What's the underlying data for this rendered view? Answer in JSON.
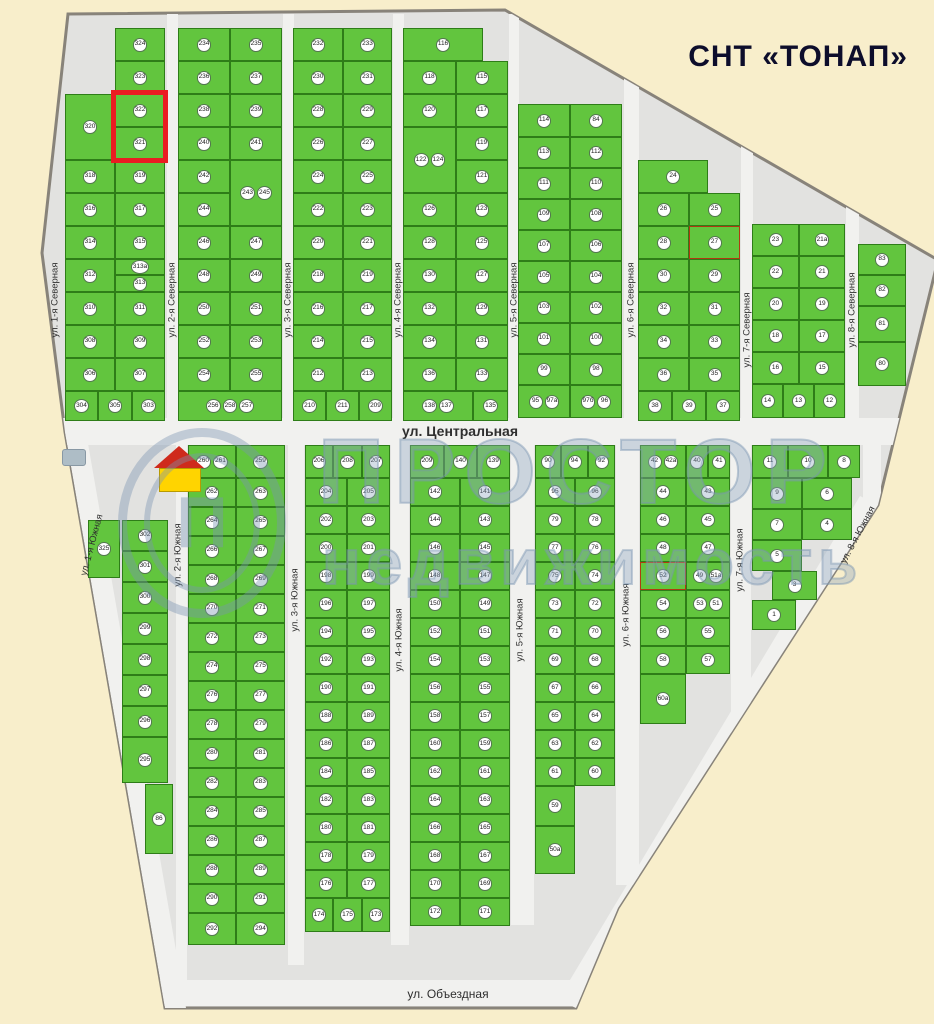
{
  "title": "СНТ «ТОНАП»",
  "watermark": {
    "line1": "ПРОСТОР",
    "line2": "недвижимость",
    "logo_letter": "П"
  },
  "colors": {
    "page": "#f8eecb",
    "map": "#e2e2e0",
    "street": "#f1f1ef",
    "plot": "#62c53e",
    "plot-border": "#2e7d18",
    "badge-bg": "#ffffff",
    "badge-border": "#53774f",
    "label": "#222222",
    "highlight": "#ea1c22",
    "title": "#0d0d2b",
    "street-text": "#2f2f2f",
    "accent": "#b03a10",
    "watermark": "#8fa6bf"
  },
  "highlight_plots": [
    "322",
    "321"
  ],
  "streets": [
    {
      "n": "ул. 1-я Северная",
      "x": 55,
      "y": 300,
      "a": -90
    },
    {
      "n": "ул. 2-я Северная",
      "x": 172,
      "y": 300,
      "a": -90
    },
    {
      "n": "ул. 3-я Северная",
      "x": 288,
      "y": 300,
      "a": -90
    },
    {
      "n": "ул. 4-я Северная",
      "x": 398,
      "y": 300,
      "a": -90
    },
    {
      "n": "ул. 5-я Северная",
      "x": 514,
      "y": 300,
      "a": -90
    },
    {
      "n": "ул. 6-я Северная",
      "x": 631,
      "y": 300,
      "a": -90
    },
    {
      "n": "ул. 7-я Северная",
      "x": 747,
      "y": 330,
      "a": -90
    },
    {
      "n": "ул. 8-я Северная",
      "x": 852,
      "y": 310,
      "a": -90
    },
    {
      "n": "ул. Центральная",
      "x": 460,
      "y": 431,
      "a": 0,
      "fs": 14,
      "b": 1
    },
    {
      "n": "ул. 1-я Южная",
      "x": 92,
      "y": 545,
      "a": -75
    },
    {
      "n": "ул. 2-я Южная",
      "x": 178,
      "y": 555,
      "a": -90
    },
    {
      "n": "ул. 3-я Южная",
      "x": 295,
      "y": 600,
      "a": -90
    },
    {
      "n": "ул. 4-я Южная",
      "x": 399,
      "y": 640,
      "a": -90
    },
    {
      "n": "ул. 5-я Южная",
      "x": 520,
      "y": 630,
      "a": -90
    },
    {
      "n": "ул. 6-я Южная",
      "x": 626,
      "y": 615,
      "a": -90
    },
    {
      "n": "ул. 7-я Южная",
      "x": 740,
      "y": 560,
      "a": -90
    },
    {
      "n": "ул. 8-я Южная",
      "x": 858,
      "y": 535,
      "a": -62
    },
    {
      "n": "ул. Объездная",
      "x": 448,
      "y": 994,
      "a": 0,
      "fs": 12
    }
  ],
  "blocks": [
    {
      "name": "north-1",
      "strips": [
        {
          "x": 65,
          "y": 94,
          "w": 50,
          "dir": "v",
          "cs": 33,
          "cells": [
            {
              "n": "320",
              "s": 66
            },
            "318",
            "316",
            "314",
            "312",
            "310",
            "308",
            "306"
          ]
        },
        {
          "x": 115,
          "y": 28,
          "w": 50,
          "dir": "v",
          "cs": 33,
          "cells": [
            "324",
            "323",
            "322",
            "321",
            "319",
            "317",
            "315",
            {
              "n": "313а",
              "s": 16
            },
            {
              "n": "313",
              "s": 17
            },
            "311",
            "309",
            "307"
          ]
        },
        {
          "x": 65,
          "y": 391,
          "h": 30,
          "dir": "h",
          "cs": 33,
          "cells": [
            "304",
            {
              "n": "305",
              "s": 34
            },
            "303"
          ]
        }
      ]
    },
    {
      "name": "north-2",
      "strips": [
        {
          "x": 178,
          "y": 28,
          "w": 52,
          "dir": "v",
          "cs": 33,
          "cells": [
            "234",
            "236",
            "238",
            "240",
            "242",
            "244",
            "246",
            "248",
            "250",
            "252",
            "254"
          ]
        },
        {
          "x": 230,
          "y": 28,
          "w": 52,
          "dir": "v",
          "cs": 33,
          "cells": [
            "235",
            "237",
            "239",
            "241",
            {
              "ns": [
                "243",
                "245"
              ],
              "s": 66
            },
            "247",
            "249",
            "251",
            "253",
            "255"
          ]
        },
        {
          "x": 178,
          "y": 391,
          "h": 30,
          "dir": "h",
          "cs": 104,
          "cells": [
            {
              "ns": [
                "256",
                "258",
                "257"
              ]
            }
          ]
        }
      ]
    },
    {
      "name": "north-3",
      "strips": [
        {
          "x": 293,
          "y": 28,
          "w": 50,
          "dir": "v",
          "cs": 33,
          "cells": [
            "232",
            "230",
            "228",
            "226",
            "224",
            "222",
            "220",
            "218",
            "216",
            "214",
            "212"
          ]
        },
        {
          "x": 343,
          "y": 28,
          "w": 49,
          "dir": "v",
          "cs": 33,
          "cells": [
            "233",
            "231",
            "229",
            "227",
            "225",
            "223",
            "221",
            "219",
            "217",
            "215",
            "213"
          ]
        },
        {
          "x": 293,
          "y": 391,
          "h": 30,
          "dir": "h",
          "cs": 33,
          "cells": [
            "210",
            "211",
            "209"
          ]
        }
      ]
    },
    {
      "name": "north-4",
      "strips": [
        {
          "x": 403,
          "y": 28,
          "h": 33,
          "dir": "h",
          "cs": 80,
          "cells": [
            {
              "n": "116"
            }
          ]
        },
        {
          "x": 403,
          "y": 61,
          "w": 53,
          "dir": "v",
          "cs": 33,
          "cells": [
            "118",
            "120",
            {
              "ns": [
                "122",
                "124"
              ],
              "s": 66
            },
            "126",
            "128",
            "130",
            "132",
            "134",
            "136"
          ]
        },
        {
          "x": 456,
          "y": 61,
          "w": 52,
          "dir": "v",
          "cs": 33,
          "cells": [
            "115",
            "117",
            "119",
            "121",
            "123",
            "125",
            "127",
            "129",
            "131",
            "133"
          ]
        },
        {
          "x": 403,
          "y": 391,
          "h": 30,
          "dir": "h",
          "cs": 35,
          "cells": [
            {
              "ns": [
                "138",
                "137"
              ],
              "s": 70
            },
            {
              "n": "135"
            }
          ]
        }
      ]
    },
    {
      "name": "north-5",
      "strips": [
        {
          "x": 518,
          "y": 104,
          "h": 33,
          "dir": "h",
          "cs": 52,
          "cells": [
            "114",
            "84"
          ]
        },
        {
          "x": 518,
          "y": 137,
          "w": 52,
          "dir": "v",
          "cs": 31,
          "cells": [
            "113",
            "111",
            "109",
            "107",
            "105",
            "103",
            "101",
            "99"
          ]
        },
        {
          "x": 570,
          "y": 137,
          "w": 52,
          "dir": "v",
          "cs": 31,
          "cells": [
            "112",
            "110",
            "108",
            "106",
            "104",
            "102",
            "100",
            "98"
          ]
        },
        {
          "x": 518,
          "y": 385,
          "h": 33,
          "dir": "h",
          "cs": 52,
          "cells": [
            {
              "ns": [
                "95",
                "97а"
              ]
            },
            {
              "ns": [
                "97б",
                "96"
              ]
            }
          ]
        }
      ]
    },
    {
      "name": "north-6",
      "strips": [
        {
          "x": 638,
          "y": 160,
          "h": 33,
          "dir": "h",
          "cs": 70,
          "cells": [
            {
              "n": "24"
            }
          ]
        },
        {
          "x": 638,
          "y": 193,
          "w": 51,
          "dir": "v",
          "cs": 33,
          "cells": [
            "26",
            "28",
            "30",
            "32",
            "34",
            "36"
          ]
        },
        {
          "x": 689,
          "y": 193,
          "w": 51,
          "dir": "v",
          "cs": 33,
          "cells": [
            "25",
            {
              "n": "27",
              "a": 1
            },
            "29",
            "31",
            "33",
            "35"
          ]
        },
        {
          "x": 638,
          "y": 391,
          "h": 30,
          "dir": "h",
          "cs": 34,
          "cells": [
            "38",
            "39",
            "37"
          ]
        }
      ]
    },
    {
      "name": "north-7",
      "strips": [
        {
          "x": 752,
          "y": 224,
          "w": 47,
          "dir": "v",
          "cs": 32,
          "cells": [
            "23",
            "22",
            "20",
            "18",
            "16"
          ]
        },
        {
          "x": 799,
          "y": 224,
          "w": 46,
          "dir": "v",
          "cs": 32,
          "cells": [
            "21а",
            "21",
            "19",
            "17",
            "15"
          ]
        },
        {
          "x": 752,
          "y": 384,
          "h": 34,
          "dir": "h",
          "cs": 31,
          "cells": [
            "14",
            "13",
            "12"
          ]
        }
      ]
    },
    {
      "name": "north-8",
      "strips": [
        {
          "x": 858,
          "y": 244,
          "w": 48,
          "dir": "v",
          "cs": 31,
          "cells": [
            "83",
            "82",
            {
              "n": "81",
              "s": 36
            },
            {
              "n": "80",
              "s": 44
            }
          ]
        }
      ]
    },
    {
      "name": "south-1",
      "strips": [
        {
          "x": 88,
          "y": 520,
          "w": 32,
          "dir": "v",
          "cs": 58,
          "cells": [
            "325"
          ]
        },
        {
          "x": 122,
          "y": 520,
          "w": 46,
          "dir": "v",
          "cs": 31,
          "cells": [
            "302",
            "301",
            "300",
            "299",
            "298",
            "297",
            "296",
            {
              "n": "295",
              "s": 46
            }
          ]
        },
        {
          "x": 145,
          "y": 784,
          "w": 28,
          "dir": "v",
          "cs": 70,
          "cells": [
            "86"
          ]
        }
      ]
    },
    {
      "name": "south-2",
      "strips": [
        {
          "x": 188,
          "y": 445,
          "h": 33,
          "dir": "h",
          "cs": 48,
          "cells": [
            {
              "ns": [
                "260",
                "261"
              ]
            },
            {
              "n": "259",
              "s": 49
            }
          ]
        },
        {
          "x": 188,
          "y": 478,
          "w": 48,
          "dir": "v",
          "cs": 29,
          "cells": [
            "262",
            "264",
            "266",
            "268",
            "270",
            "272",
            "274",
            "276",
            "278",
            "280",
            "282",
            "284",
            "286",
            "288",
            "290"
          ]
        },
        {
          "x": 236,
          "y": 478,
          "w": 49,
          "dir": "v",
          "cs": 29,
          "cells": [
            "263",
            "265",
            "267",
            "269",
            "271",
            "273",
            "275",
            "277",
            "279",
            "281",
            "283",
            "285",
            "287",
            "289",
            "291"
          ]
        },
        {
          "x": 188,
          "y": 913,
          "h": 32,
          "dir": "h",
          "cs": 48,
          "cells": [
            "292",
            {
              "n": "294",
              "s": 49
            }
          ]
        }
      ]
    },
    {
      "name": "south-3",
      "strips": [
        {
          "x": 305,
          "y": 445,
          "h": 33,
          "dir": "h",
          "cs": 28,
          "cells": [
            "206",
            {
              "n": "208",
              "s": 29
            },
            "207"
          ]
        },
        {
          "x": 305,
          "y": 478,
          "w": 42,
          "dir": "v",
          "cs": 28,
          "cells": [
            "204",
            "202",
            "200",
            "198",
            "196",
            "194",
            "192",
            "190",
            "188",
            "186",
            "184",
            "182",
            "180",
            "178",
            "176"
          ]
        },
        {
          "x": 347,
          "y": 478,
          "w": 43,
          "dir": "v",
          "cs": 28,
          "cells": [
            "205",
            "203",
            "201",
            "199",
            "197",
            "195",
            "193",
            "191",
            "189",
            "187",
            "185",
            "183",
            "181",
            "179",
            "177"
          ]
        },
        {
          "x": 305,
          "y": 898,
          "h": 34,
          "dir": "h",
          "cs": 28,
          "cells": [
            "174",
            {
              "n": "175",
              "s": 29
            },
            "173"
          ]
        }
      ]
    },
    {
      "name": "south-4",
      "strips": [
        {
          "x": 410,
          "y": 445,
          "h": 33,
          "dir": "h",
          "cs": 33,
          "cells": [
            {
              "n": "209",
              "s": 34
            },
            "140",
            "139"
          ]
        },
        {
          "x": 410,
          "y": 478,
          "w": 50,
          "dir": "v",
          "cs": 28,
          "cells": [
            "142",
            "144",
            "146",
            "148",
            "150",
            "152",
            "154",
            "156",
            "158",
            "160",
            "162",
            "164",
            "166",
            "168",
            "170",
            "172"
          ]
        },
        {
          "x": 460,
          "y": 478,
          "w": 50,
          "dir": "v",
          "cs": 28,
          "cells": [
            "141",
            "143",
            "145",
            "147",
            "149",
            "151",
            "153",
            "155",
            "157",
            "159",
            "161",
            "163",
            "165",
            "167",
            "169",
            "171"
          ]
        }
      ]
    },
    {
      "name": "south-5",
      "strips": [
        {
          "x": 535,
          "y": 445,
          "h": 33,
          "dir": "h",
          "cs": 26,
          "cells": [
            "90",
            {
              "n": "94",
              "s": 27
            },
            {
              "n": "92",
              "s": 27
            }
          ]
        },
        {
          "x": 535,
          "y": 478,
          "w": 40,
          "dir": "v",
          "cs": 28,
          "cells": [
            "95",
            "79",
            "77",
            "75",
            "73",
            "71",
            "69",
            "67",
            "65",
            "63",
            "61",
            {
              "n": "59",
              "s": 40
            },
            {
              "n": "50а",
              "s": 48
            }
          ]
        },
        {
          "x": 575,
          "y": 478,
          "w": 40,
          "dir": "v",
          "cs": 28,
          "cells": [
            "96",
            "78",
            "76",
            "74",
            "72",
            "70",
            "68",
            "66",
            "64",
            "62",
            "60"
          ]
        }
      ]
    },
    {
      "name": "south-6",
      "strips": [
        {
          "x": 640,
          "y": 445,
          "h": 33,
          "dir": "h",
          "cs": 22,
          "cells": [
            {
              "ns": [
                "42",
                "42а"
              ],
              "s": 46
            },
            "40",
            "41"
          ]
        },
        {
          "x": 640,
          "y": 478,
          "w": 46,
          "dir": "v",
          "cs": 28,
          "cells": [
            "44",
            "46",
            "48",
            {
              "n": "52",
              "a": 1
            },
            "54",
            "56",
            "58",
            {
              "n": "60а",
              "s": 50
            }
          ]
        },
        {
          "x": 686,
          "y": 478,
          "w": 44,
          "dir": "v",
          "cs": 28,
          "cells": [
            "43",
            "45",
            "47",
            {
              "ns": [
                "49",
                "51а"
              ]
            },
            {
              "ns": [
                "53",
                "51"
              ]
            },
            "55",
            "57"
          ]
        }
      ]
    },
    {
      "name": "south-7",
      "strips": [
        {
          "x": 752,
          "y": 445,
          "h": 33,
          "dir": "h",
          "cs": 36,
          "cells": [
            "11",
            {
              "n": "10",
              "s": 40
            },
            {
              "n": "8",
              "s": 32
            }
          ]
        },
        {
          "x": 752,
          "y": 478,
          "w": 50,
          "dir": "v",
          "cs": 31,
          "cells": [
            "9",
            "7",
            "5"
          ]
        },
        {
          "x": 802,
          "y": 478,
          "w": 50,
          "dir": "v",
          "cs": 31,
          "cells": [
            "6",
            "4"
          ]
        },
        {
          "x": 772,
          "y": 571,
          "h": 29,
          "dir": "h",
          "cs": 45,
          "cells": [
            "3"
          ]
        },
        {
          "x": 752,
          "y": 600,
          "h": 30,
          "dir": "h",
          "cs": 44,
          "cells": [
            "1"
          ]
        }
      ]
    }
  ]
}
